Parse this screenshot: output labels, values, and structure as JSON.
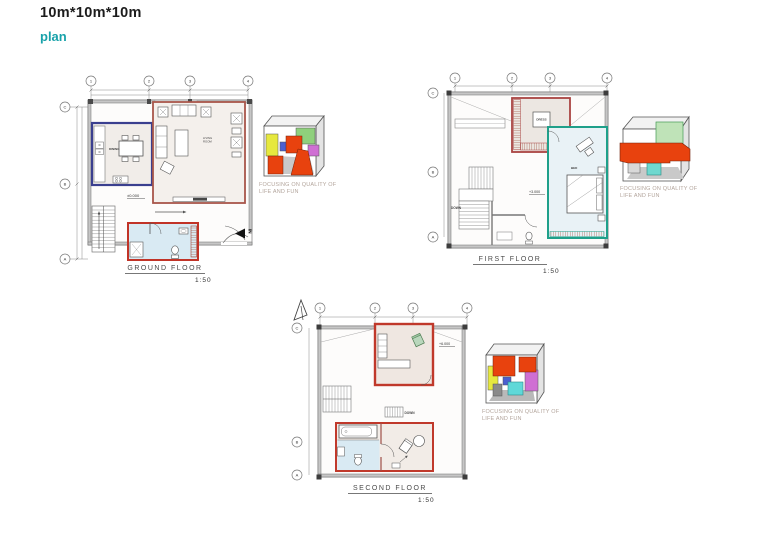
{
  "page": {
    "title": "10m*10m*10m",
    "subtitle": "plan"
  },
  "captions": {
    "line1": "FOCUSING ON QUALITY OF",
    "line2": "LIFE AND FUN"
  },
  "grid": {
    "columns": [
      "1",
      "2",
      "3",
      "4"
    ],
    "rows": [
      "C",
      "B",
      "A"
    ]
  },
  "floors": [
    {
      "name": "GROUND FLOOR",
      "scale": "1:50",
      "level": "±0.000",
      "labels": {
        "living1": "LIVING",
        "living2": "ROOM",
        "dining": "DINING",
        "entry": "IN"
      }
    },
    {
      "name": "FIRST FLOOR",
      "scale": "1:50",
      "level": "+3.000",
      "labels": {
        "dress": "DRESS",
        "bed": "BED",
        "down": "DOWN"
      }
    },
    {
      "name": "SECOND FLOOR",
      "scale": "1:50",
      "level": "+6.000",
      "labels": {
        "down": "DOWN"
      }
    }
  ],
  "colors": {
    "accent_teal": "#18a2aa",
    "room_blue": "#3a3f8f",
    "room_red_living": "#a8564a",
    "room_red": "#c13327",
    "room_teal": "#1fa08a",
    "bath_floor": "#d9eaf3",
    "axon_red": "#e8420e",
    "axon_yellow": "#e6e83e",
    "axon_green": "#8fd07c",
    "axon_magenta": "#cf6fd3",
    "axon_cyan": "#5fd8d8",
    "axon_blue": "#4a5fd0"
  }
}
